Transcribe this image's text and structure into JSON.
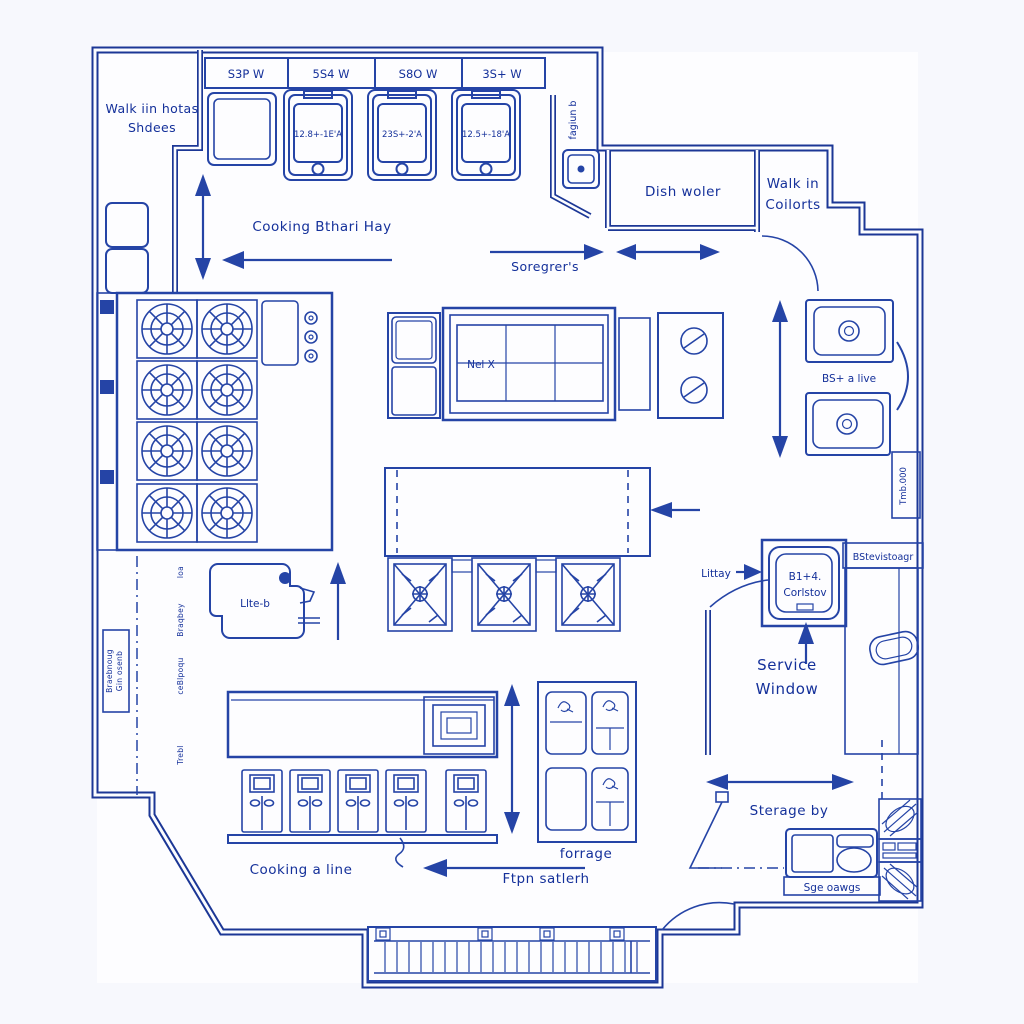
{
  "title": "Commercial kitchen blueprint floor plan",
  "colors": {
    "ink": "#1c3796",
    "line": "#2544a6",
    "text": "#14309a",
    "paper": "#f7f8fd"
  },
  "rooms": {
    "walk_in_top_line1": "Walk iin hotas",
    "walk_in_top_line2": "Shdees",
    "dish_room": "Dish woler",
    "walk_in_right_line1": "Walk in",
    "walk_in_right_line2": "Coilorts",
    "service_line1": "Service",
    "service_line2": "Window",
    "storage": "Sterage by"
  },
  "equipment": {
    "dims": [
      "S3P W",
      "5S4 W",
      "S8O W",
      "3S+ W"
    ],
    "fryer_labels": [
      "12.8+-1E'A",
      "23S+-2'A",
      "12.5+-18'A"
    ],
    "fagiun": "fagiun b",
    "nel_x": "Nel X",
    "bs_live": "BS+ a live",
    "tmb": "Tmb.000",
    "corlstov_line1": "B1+4.",
    "corlstov_line2": "Corlstov",
    "bstevistoag": "BStevistoagr",
    "littay": "Littay",
    "llte": "Llte-b",
    "sge_ouwgs": "Sge oawgs",
    "forrage": "forrage"
  },
  "annotations": {
    "cooking_hay": "Cooking Bthari Hay",
    "soregrers": "Soregrer's",
    "cooking_line": "Cooking a line",
    "ftpn": "Ftpn satlerh",
    "side_notes": [
      "loa",
      "Braqbey",
      "ceBlpoqu",
      "Trebl"
    ],
    "wall_note_line1": "Braebnoug",
    "wall_note_line2": "Gin osenb"
  }
}
